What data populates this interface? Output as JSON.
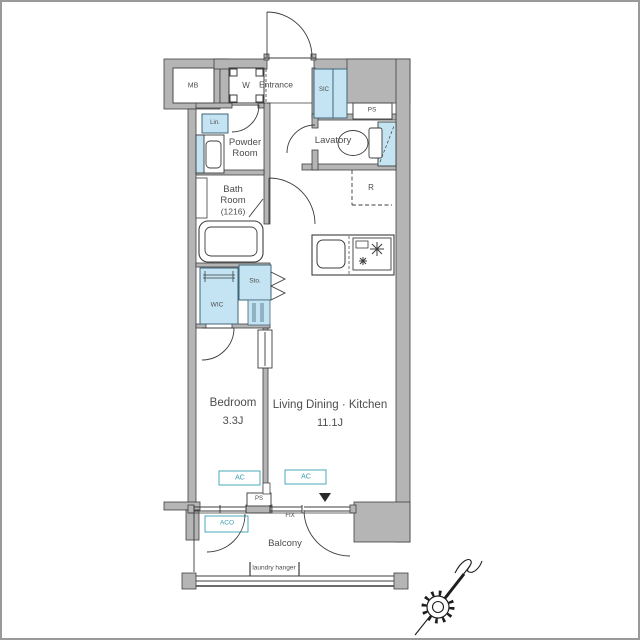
{
  "title": "1LDK apartment floor plan",
  "colors": {
    "wall_fill": "#b5b5b5",
    "outline": "#3f3f3f",
    "fixture_blue": "#c4e4f3",
    "accent_teal": "#3a9cae",
    "text": "#4c4c4c"
  },
  "labels": {
    "mb": "MB",
    "washer": "W",
    "entrance": "Entrance",
    "sic": "SIC",
    "ps_top": "PS",
    "linen": "Lin.",
    "powder_line1": "Powder",
    "powder_line2": "Room",
    "lavatory": "Lavatory",
    "bath_line1": "Bath",
    "bath_line2": "Room",
    "bath_line3": "(1216)",
    "refrigerator": "R",
    "storage": "Sto.",
    "wic": "WIC",
    "bedroom_name": "Bedroom",
    "bedroom_size": "3.3J",
    "ldk_name": "Living Dining · Kitchen",
    "ldk_size": "11.1J",
    "ac_bedroom": "AC",
    "ac_living": "AC",
    "ps_bottom": "PS",
    "fix": "FIX",
    "aco": "ACO",
    "balcony": "Balcony",
    "laundry_hanger": "laundry hanger"
  }
}
